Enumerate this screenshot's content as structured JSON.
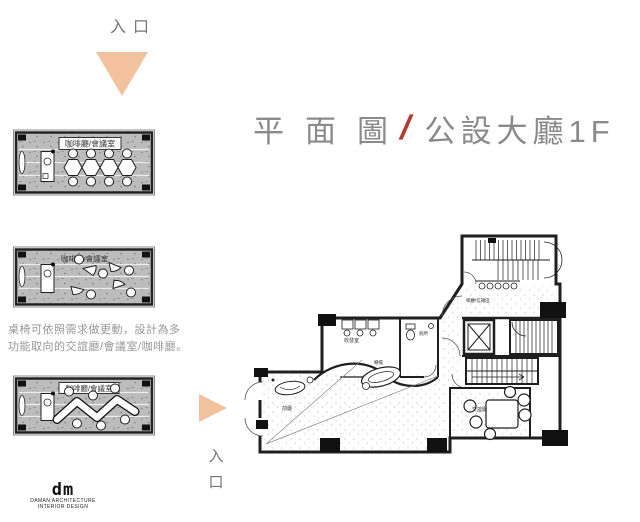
{
  "entrance_top": {
    "label": "入口"
  },
  "entrance_side": {
    "char1": "入",
    "char2": "口"
  },
  "title": {
    "part1": "平面圖",
    "slash": "/",
    "part2": "公設大廳1F"
  },
  "description": {
    "line1": "桌椅可依照需求做更動，設計為多",
    "line2": "功能取向的交誼廳/會議室/咖啡廳。"
  },
  "thumbnails": [
    {
      "label": "咖啡廳/會議室",
      "variant": "hex-conference-tables"
    },
    {
      "label": "咖啡廳/會議室",
      "variant": "scattered-lounge-chairs"
    },
    {
      "label": "咖啡廳/會議室",
      "variant": "zigzag-tables"
    }
  ],
  "floor_plan": {
    "rooms": {
      "stair_hall": "梯廳/信箱區",
      "mail_room": "收發室",
      "toilet": "廁所",
      "counter": "櫃檯",
      "front_hall": "前廳",
      "lounge": "交誼廳"
    }
  },
  "logo": {
    "mark": "dm",
    "line1": "DAMAN ARCHITECTURE",
    "line2": "INTERIOR DESIGN"
  },
  "colors": {
    "accent_peach": "#f2c29e",
    "slash_red": "#b23b32",
    "title_gray": "#8a8a8a",
    "description_gray": "#979797",
    "plan_ink": "#1f1f1f"
  }
}
